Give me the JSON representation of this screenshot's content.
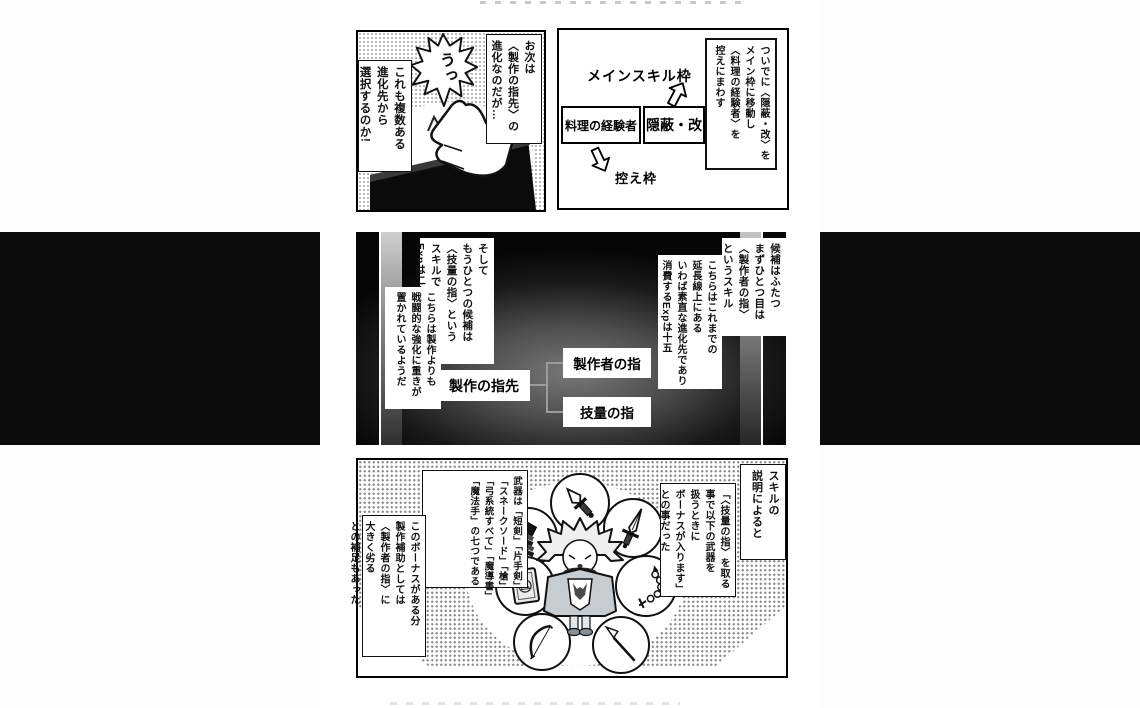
{
  "colors": {
    "page_background": "#ffffff",
    "bleed_band": "#0b0b0b",
    "dark_panel_center": "#787878",
    "halftone_dot": "#8c8c8c",
    "connector_line": "#9b9b9b"
  },
  "top_left": {
    "shout": "うっ",
    "box_next": [
      "お次は",
      "〈製作の指先〉の",
      "進化なのだが…"
    ],
    "box_choice": [
      "これも複数ある",
      "進化先から",
      "選択するのか!"
    ]
  },
  "top_right": {
    "note": [
      "ついでに〈隠蔽・改〉を",
      "メイン枠に移動し",
      "〈料理の経験者〉を",
      "控えにまわす"
    ],
    "main_slot_label": "メインスキル枠",
    "cooking_box": "料理の経験者",
    "inpei_box": "隠蔽・改",
    "reserve_slot_label": "控え枠",
    "icons": {
      "arrow_up": "hollow-arrow-up",
      "arrow_down": "hollow-arrow-down"
    }
  },
  "middle": {
    "r1": [
      "候補はふたつ",
      "まずひとつ目は",
      "〈製作者の指〉",
      "というスキル"
    ],
    "r2": [
      "こちらはこれまでの",
      "延長線上にある",
      "いわば素直な進化先であり",
      "消費するExpは十五"
    ],
    "l1": [
      "そして",
      "もうひとつの候補は",
      "〈技量の指〉という",
      "スキルで消費する",
      "Expは二十"
    ],
    "l2": [
      "こちらは製作よりも",
      "戦闘的な強化に重きが",
      "置かれているようだ"
    ],
    "node_parent": "製作の指先",
    "node_child_top": "製作者の指",
    "node_child_bottom": "技量の指"
  },
  "bottom": {
    "r1": [
      "スキルの",
      "説明によると"
    ],
    "r2": [
      "「〈技量の指〉を取る",
      "事で以下の武器を",
      "扱うときに",
      "ボーナスが入ります」",
      "との事だった"
    ],
    "l1": [
      "武器は「短剣」「片手剣」",
      "「スネークソード」「槍」",
      "「弓系統すべて」「魔導書」",
      "「魔法手」の七つである"
    ],
    "l2": [
      "このボーナスがある分",
      "製作補助としては",
      "〈製作者の指〉に",
      "大きく劣る",
      "との補足もあった"
    ],
    "weapon_icons": [
      "dagger",
      "one-handed-sword",
      "magic-hand",
      "grimoire",
      "bow",
      "spear",
      "snake-sword"
    ]
  }
}
